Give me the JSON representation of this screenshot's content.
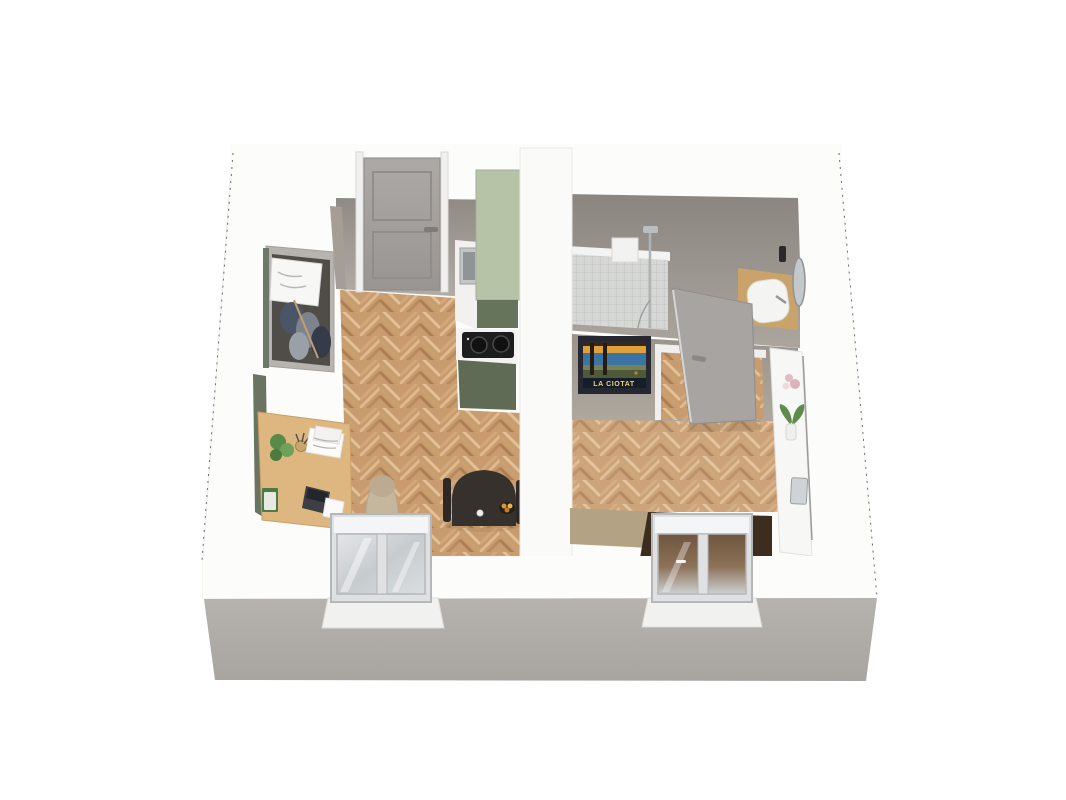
{
  "scene": {
    "title": "apartment-3d-floor-plan",
    "background": "#ffffff"
  },
  "poster": {
    "text": "LA CIOTAT"
  },
  "palette": {
    "background": "#ffffff",
    "wall_white": "#fbfbfa",
    "wall_front_face": "#b2aeaa",
    "wall_interior": "#9a948d",
    "wall_interior_dark": "#7f7a74",
    "partition_white": "#fafaf9",
    "floor_wood": "#c89c6f",
    "floor_wood_light": "#deba8e",
    "floor_wood_dark": "#ad7f54",
    "kitchen_cabinet_sage": "#b7c3a7",
    "kitchen_cabinet_olive": "#67745c",
    "kitchen_counter_white": "#f4f3f1",
    "cooktop_black": "#1d1d1d",
    "entrance_door_gray": "#a3a09d",
    "interior_door_gray": "#a7a4a1",
    "wardrobe_interior_dark": "#504c47",
    "desk_wood": "#ddb77f",
    "office_chair_beige": "#c5b69e",
    "dining_table_dark": "#36312c",
    "fruit_orange": "#dd9630",
    "shower_tile_gray": "#d7d8d6",
    "vanity_wood": "#c9a369",
    "sink_white": "#f4f4f2",
    "mirror_silver": "#c3c8cb",
    "poster_frame_dark": "#252731",
    "poster_sky_orange": "#e0a13c",
    "poster_sea_blue": "#3a74a4",
    "poster_text_yellow": "#ecd27c",
    "console_white": "#f7f7f6",
    "plant_green": "#5d8c4b",
    "flower_pink": "#e3bcc4",
    "bed_cover_brown": "#3c2d1f",
    "bed_frame_tan": "#b3a284",
    "window_frame_gray": "#dfe0e1",
    "window_glass_gray": "#ccd1d4",
    "cut_edge_dash": "#6b6b6b"
  },
  "apartment": {
    "view": "3d top-down cutaway render",
    "rooms": [
      {
        "name": "living-room-kitchen",
        "items": [
          "entrance door",
          "open wardrobe with clothes",
          "wooden desk",
          "laptop",
          "papers",
          "potted plant",
          "pen cup",
          "books",
          "office chair",
          "sage green kitchen cabinets",
          "induction cooktop",
          "kitchen sink",
          "dining table",
          "dining chairs",
          "fruit bowl",
          "casement window"
        ]
      },
      {
        "name": "bathroom",
        "items": [
          "tiled walk-in shower",
          "hand shower",
          "wooden vanity counter",
          "white sink",
          "round mirror",
          "bottle"
        ]
      },
      {
        "name": "bedroom",
        "items": [
          "interior door",
          "travel poster",
          "white console shelf",
          "vase with plant",
          "pink flowers",
          "metal tray",
          "double bed with brown cover",
          "casement window"
        ]
      }
    ]
  }
}
